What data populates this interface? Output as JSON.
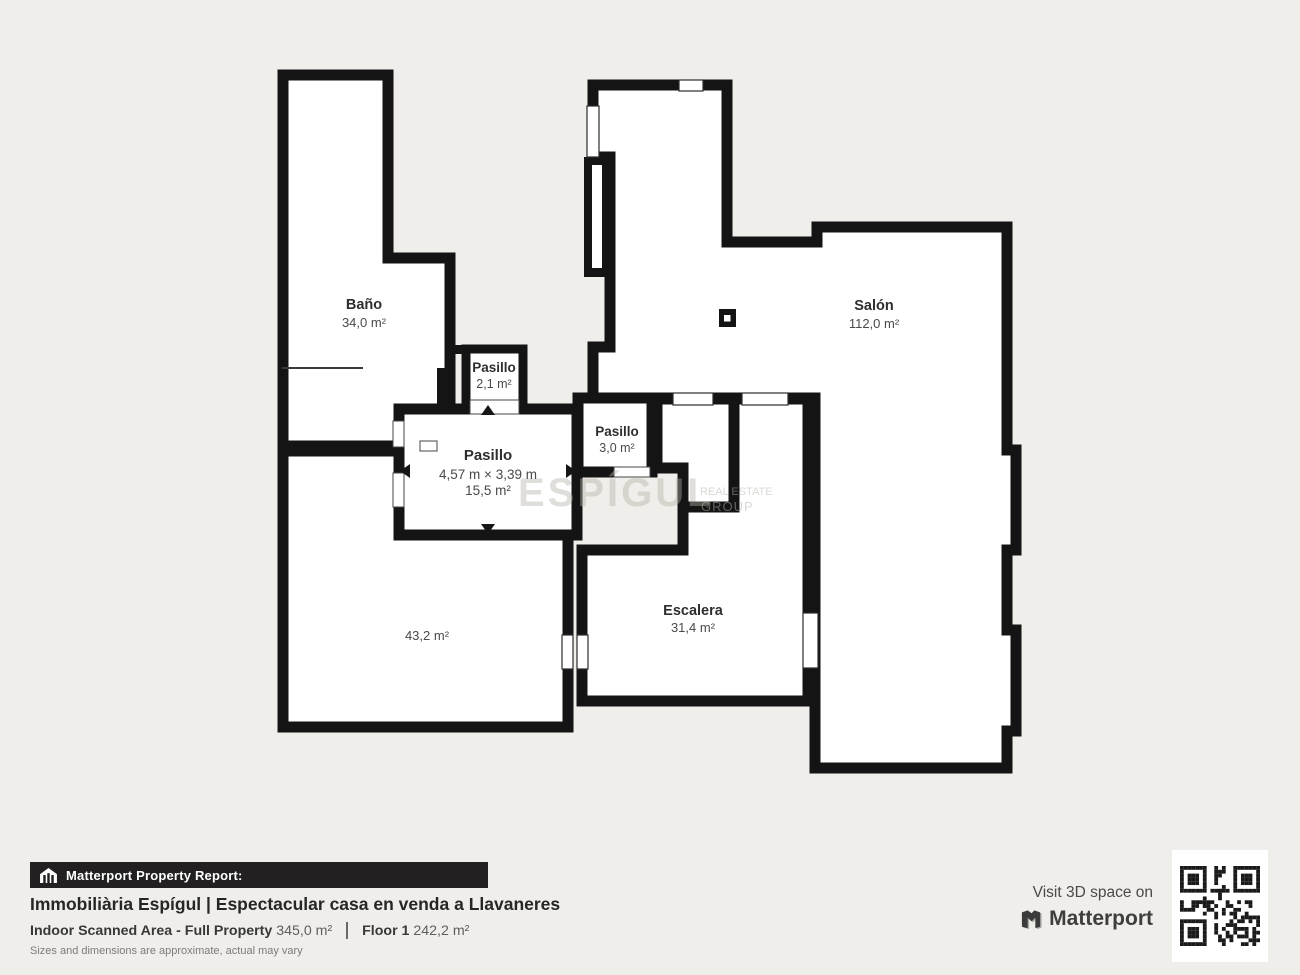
{
  "plan": {
    "rooms": [
      {
        "name": "Baño",
        "area": "34,0 m²"
      },
      {
        "name": "Salón",
        "area": "112,0 m²"
      },
      {
        "name": "Pasillo",
        "area": "2,1 m²"
      },
      {
        "name": "Pasillo",
        "dimensions": "4,57 m × 3,39 m",
        "area": "15,5 m²"
      },
      {
        "name": "Pasillo",
        "area": "3,0 m²"
      },
      {
        "name": "Escalera",
        "area": "31,4 m²"
      },
      {
        "name": "",
        "area": "43,2 m²"
      }
    ],
    "watermark": {
      "brand": "ESPÍGUL",
      "line1": "REAL ESTATE",
      "line2": "GROUP"
    }
  },
  "report": {
    "badge": "Matterport Property Report:",
    "title": "Immobiliària Espígul | Espectacular casa en venda a Llavaneres",
    "indoor_label": "Indoor Scanned Area - Full Property",
    "indoor_value": "345,0 m²",
    "floor_label": "Floor 1",
    "floor_value": "242,2 m²",
    "disclaimer": "Sizes and dimensions are approximate, actual may vary"
  },
  "cta": {
    "text": "Visit 3D space on",
    "brand": "Matterport"
  },
  "colors": {
    "background": "#f0eeea",
    "wall": "#141414",
    "room": "#ffffff",
    "bar": "#232021"
  }
}
